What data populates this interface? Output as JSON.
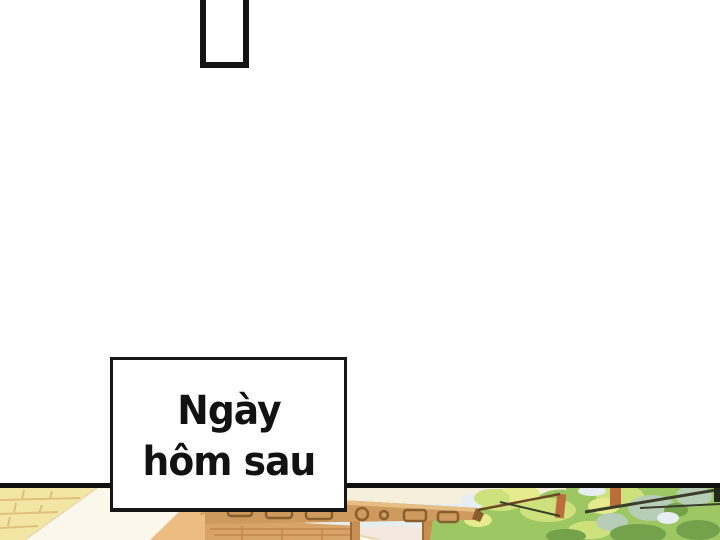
{
  "page": {
    "background": "#ffffff"
  },
  "speech_bubble": {
    "border_color": "#141414",
    "fill": "#ffffff"
  },
  "panel": {
    "divider_color": "#101010"
  },
  "caption_box": {
    "line1": "Ngày",
    "line2": "hôm sau",
    "text_color": "#121212",
    "border_color": "#161616",
    "background": "#ffffff"
  },
  "illustration": {
    "palette": {
      "backdrop": "#f6efdc",
      "brick_wall": "#f3e5a3",
      "brick_mortar": "#dfc07e",
      "roof_plane": "#fbf7ea",
      "roof_edge": "#e7d7ae",
      "hip_roof": "#ecbc82",
      "hip_lines": "#d99c59",
      "beam": "#cf9a5e",
      "beam_highlight": "#e6bd83",
      "beam_carving": "#8a5f30",
      "beam_lower": "#d8a468",
      "beam_lower_lines": "#c08a4e",
      "post": "#c78f52",
      "post_shadow": "#a06b33",
      "sky": "#e7eef2",
      "sky_warm": "#f3e8e0",
      "foliage_base": "#9cc763",
      "foliage_light": "#cfe17c",
      "foliage_yellow": "#e6ec8e",
      "foliage_sage": "#b7cdb6",
      "foliage_dark": "#74a14c",
      "trunk": "#bb6d3b",
      "branch": "#3a3e2a",
      "rail": "#6b4a26",
      "edge_shadow": "#23261a"
    }
  }
}
